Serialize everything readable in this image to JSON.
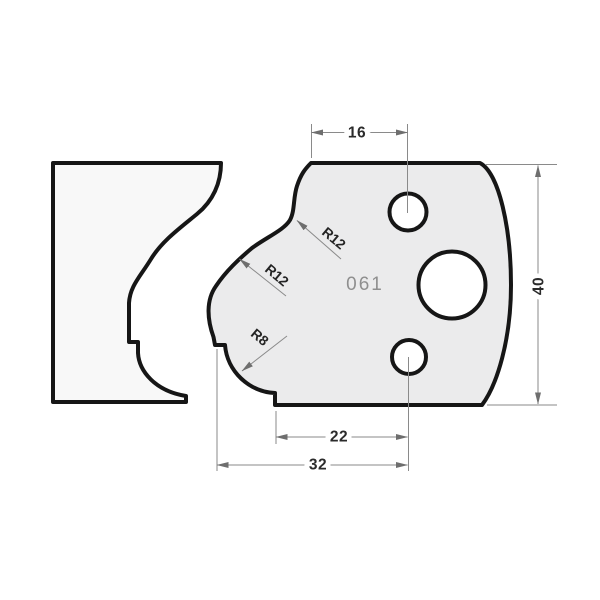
{
  "drawing": {
    "profile_number": "061",
    "dimensions": {
      "top_width": "16",
      "height": "40",
      "bottom_inner_width": "22",
      "bottom_outer_width": "32"
    },
    "radii": {
      "upper": "R12",
      "middle": "R12",
      "lower": "R8"
    },
    "colors": {
      "outline": "#161616",
      "knife_fill": "#ebebec",
      "workpiece_fill": "#f8f8f8",
      "hole_fill": "#ffffff",
      "dim_line": "#8a8a8a",
      "arrowhead": "#6e6e6e",
      "dim_text": "#2b2b2b",
      "profile_number_text": "#8f8f8f",
      "background": "#ffffff"
    }
  }
}
